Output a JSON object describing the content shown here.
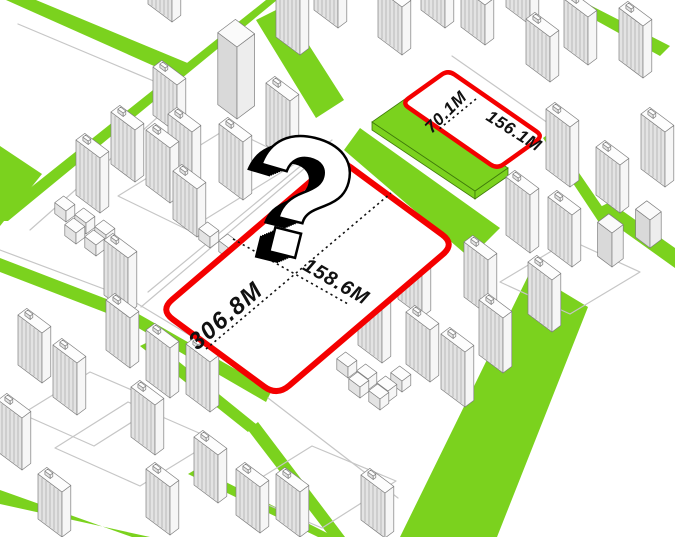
{
  "diagram": {
    "type": "isometric-site-plan",
    "question_mark": "?",
    "main_plot": {
      "length_label": "306.8M",
      "width_label": "158.6M"
    },
    "small_plot": {
      "width_label": "70.1M",
      "length_label": "156.1M"
    }
  },
  "colors": {
    "background": "#FFFFFF",
    "green": "#7BD21E",
    "green_edge": "#3F7A0B",
    "red": "#F40000",
    "building_front": "#E3E3E3",
    "building_side": "#F6F6F6",
    "building_top": "#FDFDFD",
    "office_front": "#D9D9D9",
    "office_side": "#EDEDED",
    "office_top": "#FAFAFA",
    "building_outline": "#7E7E7E",
    "stripe": "#AFAFAF",
    "path_outline": "#C6C6C6",
    "dotted_line": "#111111",
    "label_color": "#111111",
    "qm_black": "#000000",
    "qm_white": "#FFFFFF"
  }
}
